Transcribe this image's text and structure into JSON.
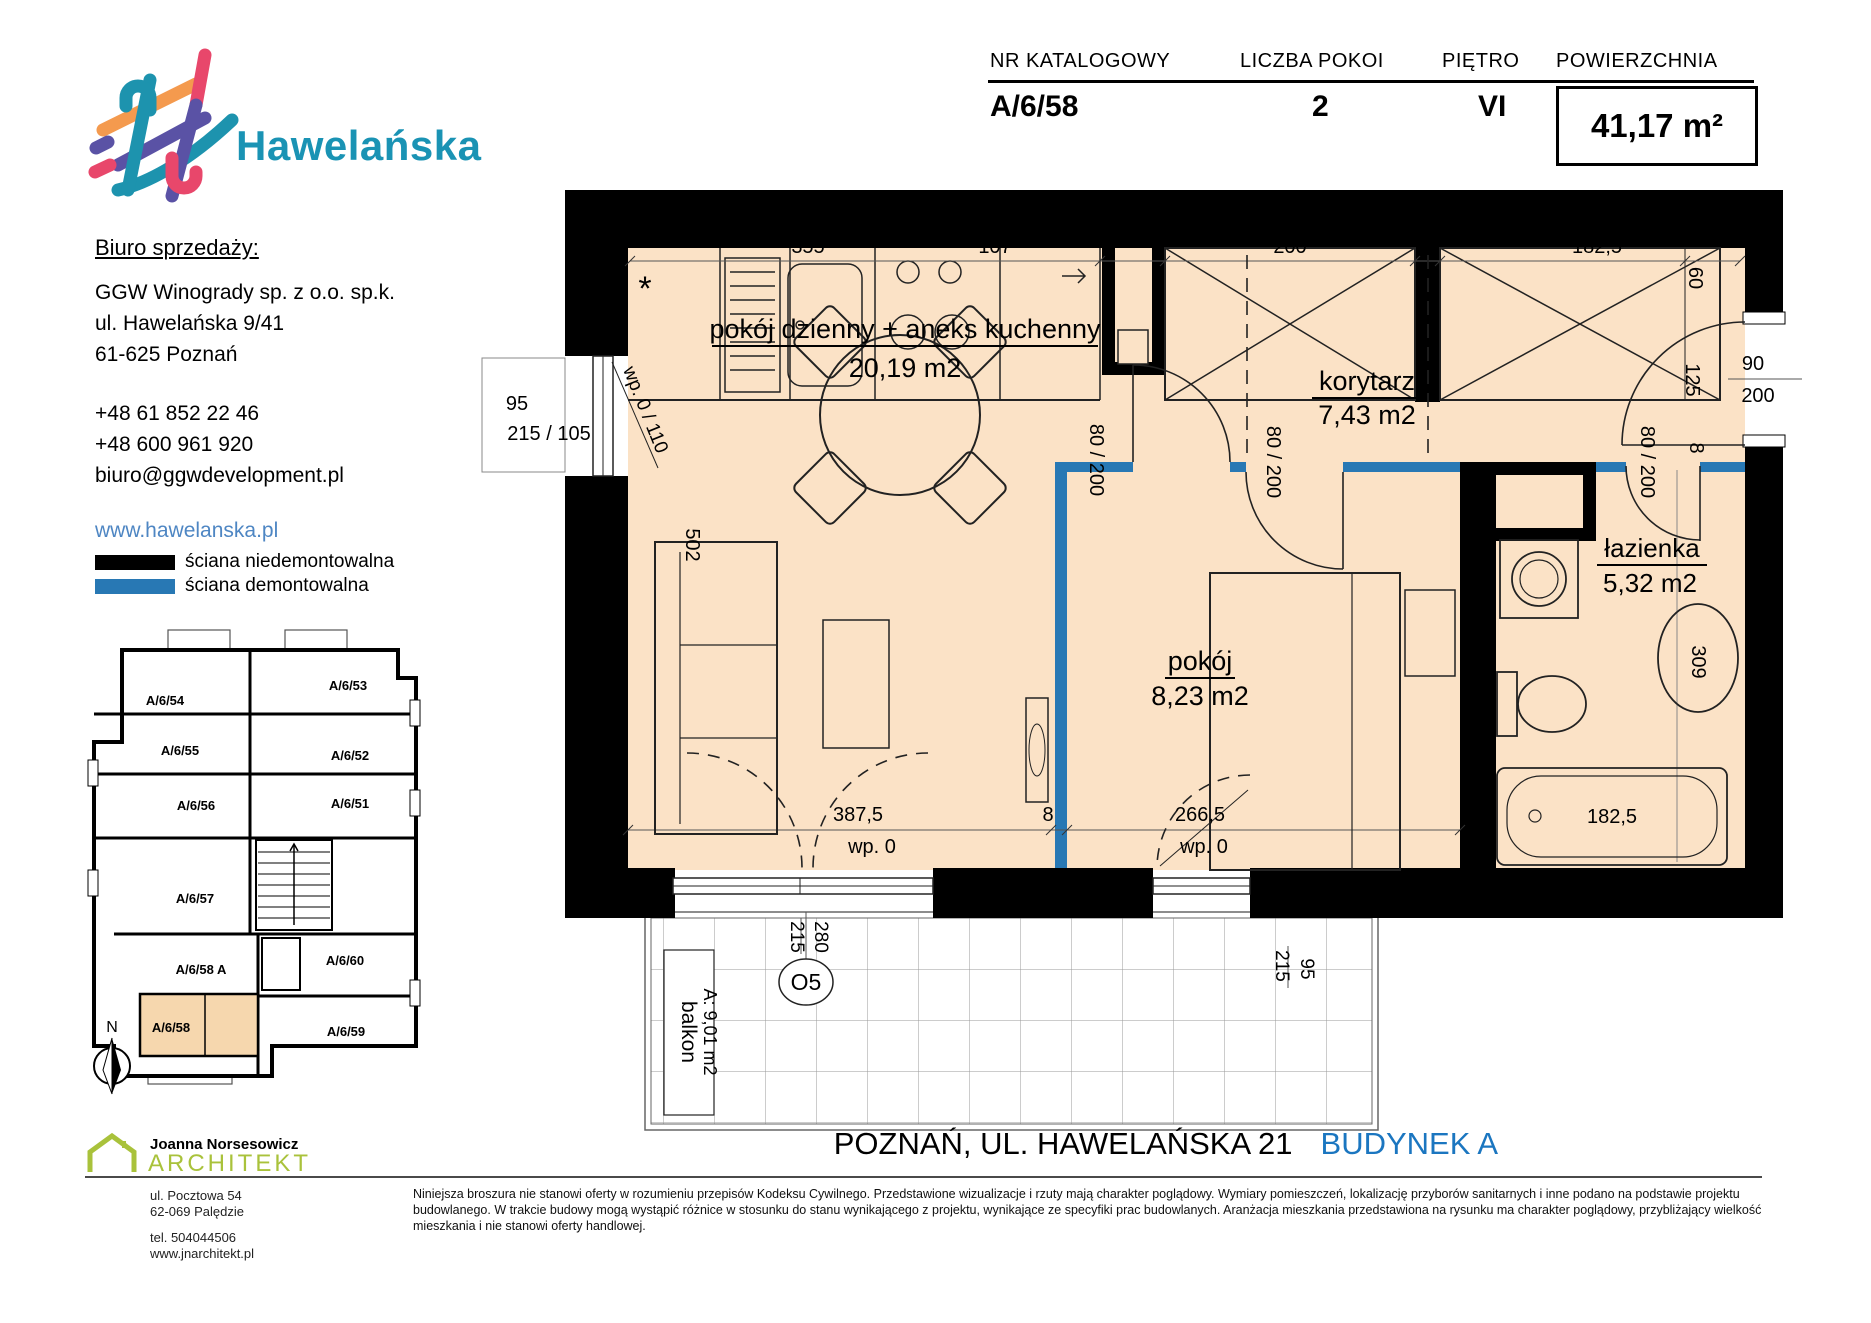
{
  "logo": {
    "brand": "Hawelańska"
  },
  "header": {
    "columns": [
      {
        "label": "NR KATALOGOWY",
        "value": "A/6/58"
      },
      {
        "label": "LICZBA POKOI",
        "value": "2"
      },
      {
        "label": "PIĘTRO",
        "value": "VI"
      },
      {
        "label": "POWIERZCHNIA",
        "value": "41,17 m²"
      }
    ]
  },
  "sales_office": {
    "heading": "Biuro sprzedaży:",
    "company": "GGW Winogrady sp. z o.o. sp.k.",
    "street": "ul. Hawelańska 9/41",
    "city": "61-625 Poznań",
    "phone1": "+48 61 852 22 46",
    "phone2": "+48 600 961 920",
    "email": "biuro@ggwdevelopment.pl",
    "website": "www.hawelanska.pl"
  },
  "legend": {
    "non_removable": "ściana niedemontowalna",
    "removable": "ściana demontowalna"
  },
  "mini_plan": {
    "units": [
      "A/6/54",
      "A/6/53",
      "A/6/55",
      "A/6/52",
      "A/6/56",
      "A/6/51",
      "A/6/57",
      "A/6/58 A",
      "A/6/60",
      "A/6/58",
      "A/6/59"
    ],
    "highlighted_unit": "A/6/58",
    "compass": "N"
  },
  "plan": {
    "rooms": [
      {
        "name": "pokój dzienny + aneks kuchenny",
        "area": "20,19 m2"
      },
      {
        "name": "korytarz",
        "area": "7,43 m2"
      },
      {
        "name": "pokój",
        "area": "8,23 m2"
      },
      {
        "name": "łazienka",
        "area": "5,32 m2"
      }
    ],
    "balcony": {
      "name": "balkon",
      "area": "A: 9,01 m2",
      "window_mark": "O5"
    },
    "symbols": {
      "kitchen_star": "*"
    },
    "dims": {
      "kitchen_width": "355",
      "niche_width": "107",
      "wardrobe1_width": "200",
      "wardrobe2_width": "182,5",
      "wardrobe_depth": "60",
      "window_height": "95",
      "window_size": "215 / 105",
      "window_sill": "wp. 0 / 110",
      "sofa_wall": "502",
      "door_living": "80 / 200",
      "door_room": "80 / 200",
      "door_bath": "80 / 200",
      "bath_wall": "8",
      "entry_clear": "125",
      "entry_door_w": "90",
      "entry_door_h": "200",
      "living_width": "387,5",
      "living_sill": "wp. 0",
      "partition": "8",
      "room_width": "266,5",
      "room_sill": "wp. 0",
      "basin_dim": "309",
      "bathtub_width": "182,5",
      "bal_door1_w": "215",
      "bal_door1_h": "280",
      "bal_door2_w": "215",
      "bal_door2_h": "95"
    }
  },
  "footer": {
    "address": "POZNAŃ, UL. HAWELAŃSKA 21",
    "building": "BUDYNEK A"
  },
  "architect": {
    "name": "Joanna Norsesowicz",
    "title": "ARCHITEKT",
    "address": "ul. Pocztowa 54\n62-069 Palędzie",
    "contact": "tel. 504044506\nwww.jnarchitekt.pl"
  },
  "disclaimer": "Niniejsza broszura nie stanowi oferty w rozumieniu przepisów Kodeksu Cywilnego. Przedstawione wizualizacje i rzuty mają charakter poglądowy. Wymiary pomieszczeń, lokalizację przyborów sanitarnych i inne podano na podstawie projektu budowlanego. W trakcie budowy mogą wystąpić różnice w stosunku do stanu wynikającego z projektu, wynikające ze specyfiki prac budowlanych. Aranżacja mieszkania przedstawiona na rysunku ma charakter poglądowy, przybliżający wielkość mieszkania i nie stanowi oferty handlowej.",
  "colors": {
    "floor": "#fbe2c6",
    "wall_black": "#000000",
    "wall_removable_blue": "#2878b4",
    "brand_teal": "#1a93b4",
    "link_blue": "#4e86c3",
    "building_blue": "#1b76c0",
    "architect_green": "#a9c23b",
    "highlight_orange": "#f6d7ae"
  }
}
